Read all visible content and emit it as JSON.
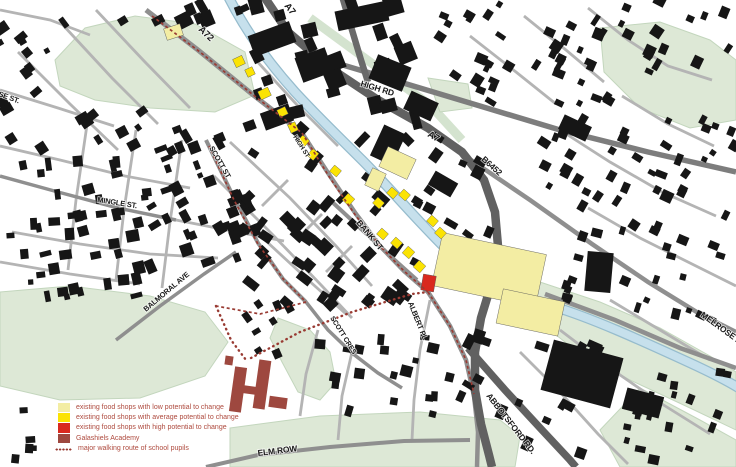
{
  "map": {
    "palette": {
      "low": "#f3eda3",
      "average": "#fbe303",
      "high": "#d9291f",
      "academy": "#9e483f",
      "route": "#993b33",
      "legend_text": "#ae4a3e",
      "water": "#c6e0ec",
      "park": "#dde8d6",
      "building": "#161616"
    },
    "legend": {
      "items": [
        {
          "key": "low",
          "label": "existing food shops with low potential to change"
        },
        {
          "key": "average",
          "label": "existing food shops with average potential to change"
        },
        {
          "key": "high",
          "label": "existing food shops with high potential to change"
        },
        {
          "key": "academy",
          "label": "Galashiels Academy"
        },
        {
          "key": "route",
          "label": "major walking route of school pupils"
        }
      ]
    },
    "street_labels": [
      {
        "id": "a72",
        "text": "A72",
        "x": 198,
        "y": 30,
        "rot": 44,
        "size": 9.5
      },
      {
        "id": "a7-top",
        "text": "A7",
        "x": 284,
        "y": 6,
        "rot": 52,
        "size": 9.5
      },
      {
        "id": "high-rd",
        "text": "HIGH RD",
        "x": 360,
        "y": 86,
        "rot": 17,
        "size": 8.5
      },
      {
        "id": "a7-mid",
        "text": "A7",
        "x": 427,
        "y": 136,
        "rot": 30,
        "size": 9.5
      },
      {
        "id": "b6452",
        "text": "B6452",
        "x": 481,
        "y": 160,
        "rot": 42,
        "size": 8.5
      },
      {
        "id": "se-st",
        "text": "SE ST.",
        "x": -2,
        "y": 96,
        "rot": 20,
        "size": 7.5
      },
      {
        "id": "mingle-st",
        "text": "MINGLE ST.",
        "x": 97,
        "y": 202,
        "rot": 9,
        "size": 7.5
      },
      {
        "id": "scott-st",
        "text": "SCOTT ST",
        "x": 209,
        "y": 148,
        "rot": 60,
        "size": 7.5
      },
      {
        "id": "high-st",
        "text": "HIGH ST",
        "x": 293,
        "y": 137,
        "rot": 57,
        "size": 6.5
      },
      {
        "id": "bank-st",
        "text": "BANK ST",
        "x": 356,
        "y": 223,
        "rot": 50,
        "size": 8.5
      },
      {
        "id": "balmoral-ave",
        "text": "BALMORAL AVE",
        "x": 146,
        "y": 312,
        "rot": -40,
        "size": 7.5
      },
      {
        "id": "albert-pl",
        "text": "ALBERT PL",
        "x": 408,
        "y": 303,
        "rot": 68,
        "size": 7.5
      },
      {
        "id": "scott-cres",
        "text": "SCOTT CRES",
        "x": 330,
        "y": 318,
        "rot": 58,
        "size": 7
      },
      {
        "id": "elm-row",
        "text": "ELM ROW",
        "x": 258,
        "y": 456,
        "rot": -7,
        "size": 8.5
      },
      {
        "id": "abbotsford-rd",
        "text": "ABBOTSFORD RD.",
        "x": 486,
        "y": 396,
        "rot": 52,
        "size": 8.5
      },
      {
        "id": "melrose-rd",
        "text": "MELROSE RD",
        "x": 700,
        "y": 316,
        "rot": 36,
        "size": 8.5
      }
    ],
    "shops": [
      {
        "x": 165,
        "y": 26,
        "w": 17,
        "h": 12,
        "rot": -18,
        "level": "low"
      },
      {
        "x": 382,
        "y": 152,
        "w": 31,
        "h": 22,
        "rot": 25,
        "level": "low"
      },
      {
        "x": 368,
        "y": 170,
        "w": 15,
        "h": 19,
        "rot": 25,
        "level": "low"
      },
      {
        "x": 436,
        "y": 243,
        "w": 106,
        "h": 54,
        "rot": 12,
        "level": "low"
      },
      {
        "x": 499,
        "y": 295,
        "w": 63,
        "h": 35,
        "rot": 12,
        "level": "low"
      },
      {
        "x": 234,
        "y": 57,
        "w": 10,
        "h": 9,
        "rot": -25,
        "level": "average"
      },
      {
        "x": 246,
        "y": 68,
        "w": 8,
        "h": 8,
        "rot": -25,
        "level": "average"
      },
      {
        "x": 259,
        "y": 89,
        "w": 11,
        "h": 9,
        "rot": -25,
        "level": "average"
      },
      {
        "x": 278,
        "y": 108,
        "w": 9,
        "h": 8,
        "rot": -25,
        "level": "average"
      },
      {
        "x": 289,
        "y": 123,
        "w": 8,
        "h": 9,
        "rot": -25,
        "level": "average"
      },
      {
        "x": 299,
        "y": 137,
        "w": 9,
        "h": 8,
        "rot": 40,
        "level": "average"
      },
      {
        "x": 309,
        "y": 150,
        "w": 8,
        "h": 9,
        "rot": 40,
        "level": "average"
      },
      {
        "x": 331,
        "y": 167,
        "w": 9,
        "h": 8,
        "rot": 40,
        "level": "average"
      },
      {
        "x": 344,
        "y": 195,
        "w": 9,
        "h": 9,
        "rot": 42,
        "level": "average"
      },
      {
        "x": 374,
        "y": 199,
        "w": 9,
        "h": 8,
        "rot": 42,
        "level": "average"
      },
      {
        "x": 388,
        "y": 189,
        "w": 9,
        "h": 8,
        "rot": 42,
        "level": "average"
      },
      {
        "x": 400,
        "y": 191,
        "w": 9,
        "h": 8,
        "rot": 42,
        "level": "average"
      },
      {
        "x": 378,
        "y": 230,
        "w": 9,
        "h": 8,
        "rot": 42,
        "level": "average"
      },
      {
        "x": 392,
        "y": 239,
        "w": 9,
        "h": 8,
        "rot": 42,
        "level": "average"
      },
      {
        "x": 404,
        "y": 248,
        "w": 9,
        "h": 9,
        "rot": 42,
        "level": "average"
      },
      {
        "x": 415,
        "y": 262,
        "w": 9,
        "h": 9,
        "rot": 42,
        "level": "average"
      },
      {
        "x": 428,
        "y": 217,
        "w": 9,
        "h": 8,
        "rot": 42,
        "level": "average"
      },
      {
        "x": 436,
        "y": 229,
        "w": 9,
        "h": 8,
        "rot": 42,
        "level": "average"
      },
      {
        "x": 422,
        "y": 275,
        "w": 13,
        "h": 16,
        "rot": 10,
        "level": "high"
      }
    ],
    "academy_parts": [
      {
        "x": 232,
        "y": 367,
        "w": 12,
        "h": 45,
        "rot": 8
      },
      {
        "x": 256,
        "y": 360,
        "w": 12,
        "h": 49,
        "rot": 8
      },
      {
        "x": 238,
        "y": 386,
        "w": 23,
        "h": 8,
        "rot": 8
      },
      {
        "x": 269,
        "y": 397,
        "w": 18,
        "h": 11,
        "rot": 8
      },
      {
        "x": 225,
        "y": 356,
        "w": 8,
        "h": 9,
        "rot": 8
      }
    ],
    "routes": [
      {
        "style": "dash",
        "points": [
          [
            152,
            16
          ],
          [
            200,
            52
          ],
          [
            252,
            94
          ],
          [
            302,
            133
          ]
        ]
      },
      {
        "style": "dash",
        "points": [
          [
            302,
            133
          ],
          [
            330,
            178
          ],
          [
            356,
            216
          ],
          [
            381,
            247
          ],
          [
            404,
            271
          ],
          [
            428,
            292
          ]
        ]
      },
      {
        "style": "dash",
        "points": [
          [
            209,
            146
          ],
          [
            234,
            200
          ],
          [
            258,
            244
          ],
          [
            284,
            280
          ],
          [
            306,
            302
          ]
        ]
      },
      {
        "style": "dash",
        "points": [
          [
            428,
            292
          ],
          [
            450,
            326
          ],
          [
            466,
            360
          ],
          [
            474,
            394
          ]
        ]
      },
      {
        "style": "dash",
        "points": [
          [
            306,
            302
          ],
          [
            260,
            314
          ],
          [
            216,
            306
          ]
        ]
      },
      {
        "style": "dot",
        "points": [
          [
            216,
            306
          ],
          [
            231,
            340
          ],
          [
            246,
            360
          ]
        ]
      },
      {
        "style": "dot",
        "points": [
          [
            251,
            358
          ],
          [
            300,
            332
          ],
          [
            352,
            312
          ],
          [
            412,
            294
          ],
          [
            428,
            292
          ]
        ]
      }
    ]
  }
}
